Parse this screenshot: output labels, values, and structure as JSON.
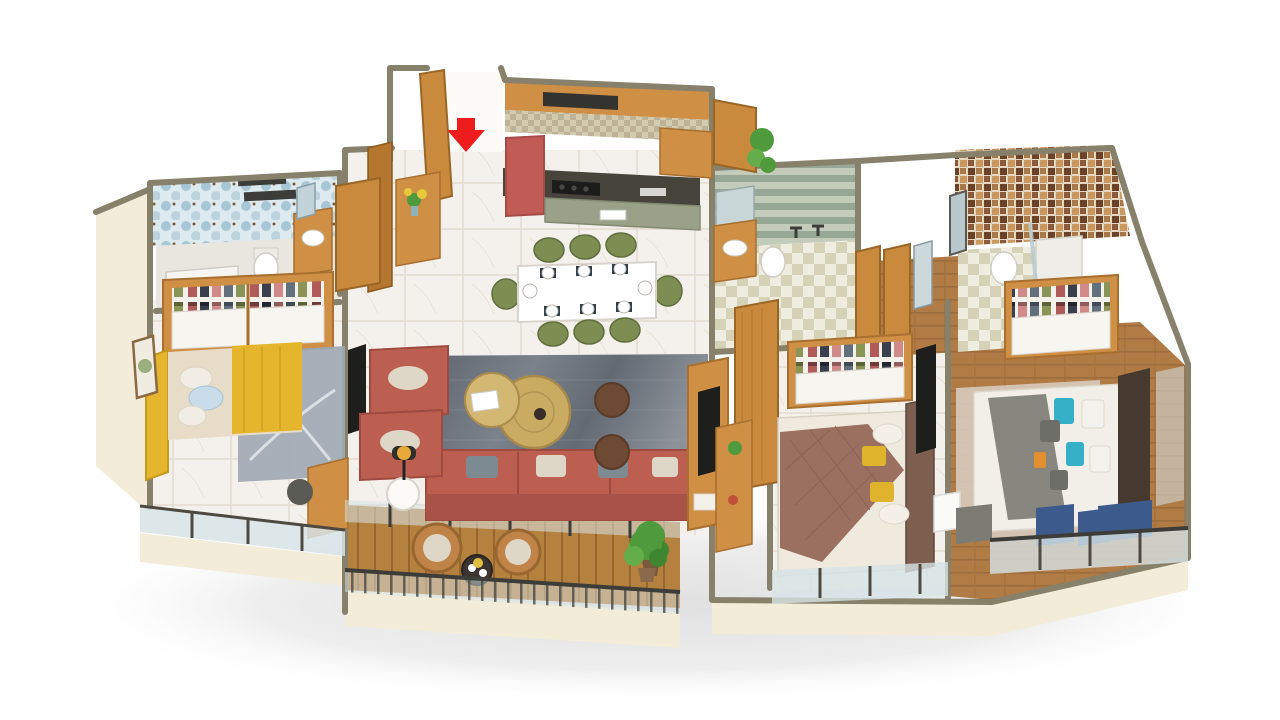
{
  "scene": {
    "type": "isometric-3d-floor-plan-render",
    "subject": "3 BHK apartment furnished floor plan, white background, no visible text",
    "rooms": [
      {
        "name": "entrance-foyer",
        "items": [
          "main-door-open",
          "red-entry-arrow",
          "console-table",
          "flower-vase",
          "tall-wood-cabinet"
        ]
      },
      {
        "name": "kitchen",
        "items": [
          "upper-wood-cabinets",
          "chimney-hood",
          "mosaic-backsplash",
          "dark-counter-with-hob",
          "red-refrigerator",
          "island-counter-sink",
          "open-slatted-door",
          "plant"
        ]
      },
      {
        "name": "dining-area",
        "items": [
          "white-dining-table",
          "eight-green-chairs",
          "place-settings"
        ]
      },
      {
        "name": "living-room",
        "items": [
          "terracotta-three-seat-sofa",
          "two-terracotta-armchairs",
          "two-round-gold-coffee-tables",
          "two-brown-poufs",
          "blue-grey-area-rug",
          "side-table",
          "black-floor-lamp",
          "tv-partition-unit",
          "floor-plant"
        ]
      },
      {
        "name": "main-balcony",
        "items": [
          "wood-deck",
          "two-rattan-chairs",
          "round-bistro-table",
          "plant",
          "glass-railing-with-balusters"
        ]
      },
      {
        "name": "bedroom-1",
        "items": [
          "yellow-frame-double-bed",
          "yellow-throw",
          "blue-and-white-pillows",
          "grey-swirl-rug",
          "open-shelf-wardrobe",
          "wall-art",
          "tv-panel",
          "study-desk-chair",
          "window-wall"
        ]
      },
      {
        "name": "bathroom-1",
        "items": [
          "blue-hex-tile-walls",
          "shower-area",
          "toilet",
          "wood-vanity-with-mirror",
          "wood-door"
        ]
      },
      {
        "name": "common-bathroom",
        "items": [
          "green-striped-tile-walls",
          "wood-vanity",
          "toilet",
          "shower-fittings",
          "checker-floor",
          "mirror"
        ]
      },
      {
        "name": "corridor",
        "items": [
          "wood-floor",
          "open-wood-doors",
          "wall-mirror"
        ]
      },
      {
        "name": "bedroom-2",
        "items": [
          "mauve-quilt-double-bed",
          "yellow-accent-pillows",
          "brown-headboard",
          "open-shelf-wardrobe",
          "wood-desk",
          "tv-panel",
          "window-wall"
        ]
      },
      {
        "name": "bathroom-3",
        "items": [
          "brown-mosaic-tile-walls",
          "toilet",
          "glass-shower",
          "checker-floor",
          "dark-mirror"
        ]
      },
      {
        "name": "bedroom-3-master",
        "items": [
          "grey-and-white-double-bed",
          "teal-pattern-pillows",
          "dark-wood-headboard",
          "beige-rug",
          "plank-wood-floor",
          "open-shelf-wardrobe",
          "three-blue-lounge-chairs",
          "grey-chair",
          "white-side-table",
          "glass-window-wall"
        ]
      }
    ]
  },
  "entrance": {
    "marker": "red-down-arrow",
    "meaning": "main entry point"
  },
  "palette": {
    "wall_top": "#87806a",
    "wall_face": "#f2ecd9",
    "marble": "#f4f1ec",
    "wood_floor": "#b07b45",
    "deck": "#b5813f",
    "cabinet_wood": "#cf8f45",
    "door_wood": "#c98a3e",
    "dark_wood": "#b5762f",
    "counter_dark": "#47443b",
    "hood_black": "#33332f",
    "island_top": "#9aa188",
    "fridge_red": "#c15b55",
    "dining_chair_green": "#7e8d51",
    "table_white": "#ffffff",
    "sofa_terracotta": "#bd5f50",
    "sofa_back": "#a85248",
    "cushion_beige": "#ded7c8",
    "pillow_grey": "#7e8a92",
    "gold_table": "#c9ab62",
    "gold_table2": "#d3b873",
    "pouf_brown": "#6d4a33",
    "rug_bed1_grey": "#9fa9b3",
    "rug_bed3_beige": "#d9cdc0",
    "bed1_yellow": "#e6b52e",
    "mattress_beige": "#e7dcc8",
    "pillow_blue": "#c8dcea",
    "quilt_mauve": "#9b7060",
    "pillow_yellow": "#e0b32c",
    "headboard2_brown": "#7d5f50",
    "bed_base_white": "#f0eade",
    "bed3_grey": "#87877f",
    "pillow_teal": "#35b0c6",
    "pillow_orange": "#e09030",
    "headboard3_dark": "#463a30",
    "chair_blue": "#3c5a8c",
    "chair_grey": "#7c7c74",
    "rattan_tan": "#c08448",
    "plant_green": "#4e9a3c",
    "glass_blue": "#d7e3e6",
    "tv_black": "#1e1e1c",
    "lamp_amber": "#e8a93c",
    "arrow_red": "#ee1c1c",
    "white": "#ffffff",
    "tile_blue_wall": "#a7c6d6",
    "tile_stripe_green": "#97a796",
    "tile_mosaic_brown": "#c9995f",
    "checker_tan": "#d6d2b8"
  }
}
